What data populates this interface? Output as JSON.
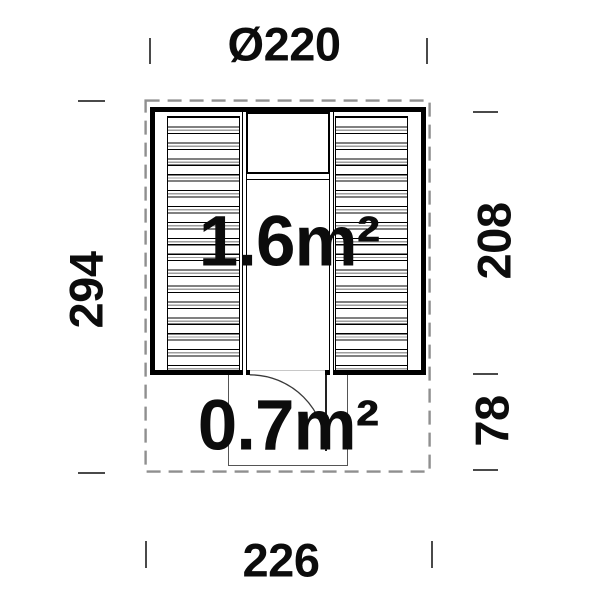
{
  "document": {
    "type": "floor-plan-drawing",
    "dimensions": {
      "top": "Ø220",
      "bottom": "226",
      "left": "294",
      "right_upper": "208",
      "right_lower": "78"
    },
    "areas": {
      "interior": "1.6m²",
      "porch": "0.7m²"
    },
    "colors": {
      "line": "#000000",
      "dashed": "#8f8f8f",
      "tick": "#4a4a4a",
      "porch": "#555555",
      "text": "#0c0c0c"
    }
  }
}
